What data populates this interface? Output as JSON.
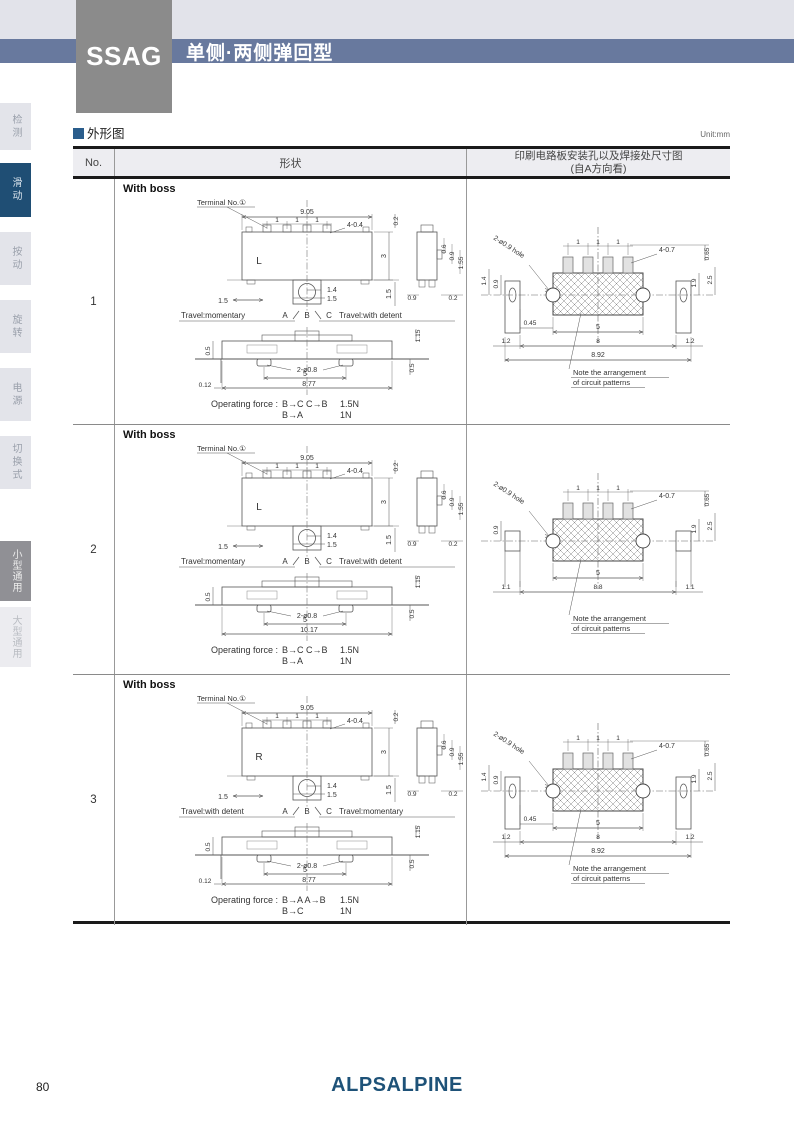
{
  "page": {
    "unit": "Unit:mm",
    "section_title": "外形图",
    "page_number": "80",
    "logo": "ALPSALPINE"
  },
  "header": {
    "series": "SSAG",
    "subtitle": "单侧·两侧弹回型"
  },
  "colors": {
    "band_blue": "#68799e",
    "tab_active_blue": "#1f4e74",
    "box_gray": "#8b8b8b",
    "logo_navy": "#1e5278",
    "section_marker_blue": "#2a5d8c"
  },
  "sidebar": [
    {
      "label": "检测",
      "style": "plain"
    },
    {
      "label": "滑动",
      "style": "blue"
    },
    {
      "label": "按动",
      "style": "plain"
    },
    {
      "label": "旋转",
      "style": "plain"
    },
    {
      "label": "电源",
      "style": "plain"
    },
    {
      "label": "切换式",
      "style": "plain"
    },
    {
      "label": "小型通用",
      "style": "gray"
    },
    {
      "label": "大型通用",
      "style": "faint"
    }
  ],
  "table": {
    "col_no": "No.",
    "col_shape": "形状",
    "col_pcb_line1": "印刷电路板安装孔以及焊接处尺寸图",
    "col_pcb_line2": "(自A方向看)"
  },
  "rows": [
    {
      "no": "1",
      "boss": "With boss",
      "front": {
        "terminal": "Terminal No.①",
        "w": "9.05",
        "p1": "1",
        "p2": "1",
        "p3": "1",
        "slot": "4-0.4",
        "t02": "0.2",
        "h": "3",
        "letter": "L",
        "knob_w": "1.4",
        "knob_w2": "1.5",
        "left15": "1.5",
        "right15": "1.5",
        "side06": "0.6",
        "side09": "0.9",
        "side155": "1.55",
        "side_b09": "0.9",
        "side_b02": "0.2",
        "travel_left": "Travel:momentary",
        "pa": "A",
        "pb": "B",
        "pc": "C",
        "travel_right": "Travel:with detent"
      },
      "bottom": {
        "d115": "1.15",
        "d05l": "0.5",
        "hole": "2-ø0.8",
        "d5": "5",
        "w": "8.77",
        "d012": "0.12",
        "d05r": "0.5"
      },
      "force": {
        "prefix": "Operating force :",
        "m1": "B→C C→B",
        "v1": "1.5N",
        "m2": "B→A",
        "v2": "1N"
      },
      "pcb": {
        "hole": "2-ø0.9 hole",
        "p1": "1",
        "p2": "1",
        "p3": "1",
        "pad": "4-0.7",
        "d065": "0.65",
        "d14": "1.4",
        "d09": "0.9",
        "d19": "1.9",
        "d25": "2.5",
        "d045": "0.45",
        "d5": "5",
        "dl": "1.2",
        "dm": "8",
        "dr": "1.2",
        "dt": "8.92",
        "note1": "Note the arrangement",
        "note2": "of circuit patterns"
      }
    },
    {
      "no": "2",
      "boss": "With boss",
      "front": {
        "terminal": "Terminal No.①",
        "w": "9.05",
        "p1": "1",
        "p2": "1",
        "p3": "1",
        "slot": "4-0.4",
        "t02": "0.2",
        "h": "3",
        "letter": "L",
        "knob_w": "1.4",
        "knob_w2": "1.5",
        "left15": "1.5",
        "right15": "1.5",
        "side06": "0.6",
        "side09": "0.9",
        "side155": "1.55",
        "side_b09": "0.9",
        "side_b02": "0.2",
        "travel_left": "Travel:momentary",
        "pa": "A",
        "pb": "B",
        "pc": "C",
        "travel_right": "Travel:with detent"
      },
      "bottom": {
        "d115": "1.15",
        "d05l": "0.5",
        "hole": "2-ø0.8",
        "d5": "5",
        "w": "10.17",
        "d05r": "0.5"
      },
      "force": {
        "prefix": "Operating force :",
        "m1": "B→C C→B",
        "v1": "1.5N",
        "m2": "B→A",
        "v2": "1N"
      },
      "pcb": {
        "hole": "2-ø0.9 hole",
        "p1": "1",
        "p2": "1",
        "p3": "1",
        "pad": "4-0.7",
        "d065": "0.65",
        "d09": "0.9",
        "d19": "1.9",
        "d25": "2.5",
        "d5": "5",
        "dl": "1.1",
        "dm": "8.8",
        "dr": "1.1",
        "note1": "Note the arrangement",
        "note2": "of circuit patterns"
      }
    },
    {
      "no": "3",
      "boss": "With boss",
      "front": {
        "terminal": "Terminal No.①",
        "w": "9.05",
        "p1": "1",
        "p2": "1",
        "p3": "1",
        "slot": "4-0.4",
        "t02": "0.2",
        "h": "3",
        "letter": "R",
        "knob_w": "1.4",
        "knob_w2": "1.5",
        "left15": "1.5",
        "right15": "1.5",
        "side06": "0.6",
        "side09": "0.9",
        "side155": "1.55",
        "side_b09": "0.9",
        "side_b02": "0.2",
        "travel_left": "Travel:with detent",
        "pa": "A",
        "pb": "B",
        "pc": "C",
        "travel_right": "Travel:momentary"
      },
      "bottom": {
        "d115": "1.15",
        "d05l": "0.5",
        "hole": "2-ø0.8",
        "d5": "5",
        "w": "8.77",
        "d012": "0.12",
        "d05r": "0.5"
      },
      "force": {
        "prefix": "Operating force :",
        "m1": "B→A A→B",
        "v1": "1.5N",
        "m2": "B→C",
        "v2": "1N"
      },
      "pcb": {
        "hole": "2-ø0.9 hole",
        "p1": "1",
        "p2": "1",
        "p3": "1",
        "pad": "4-0.7",
        "d065": "0.65",
        "d14": "1.4",
        "d09": "0.9",
        "d19": "1.9",
        "d25": "2.5",
        "d045": "0.45",
        "d5": "5",
        "dl": "1.2",
        "dm": "8",
        "dr": "1.2",
        "dt": "8.92",
        "note1": "Note the arrangement",
        "note2": "of circuit patterns"
      }
    }
  ]
}
